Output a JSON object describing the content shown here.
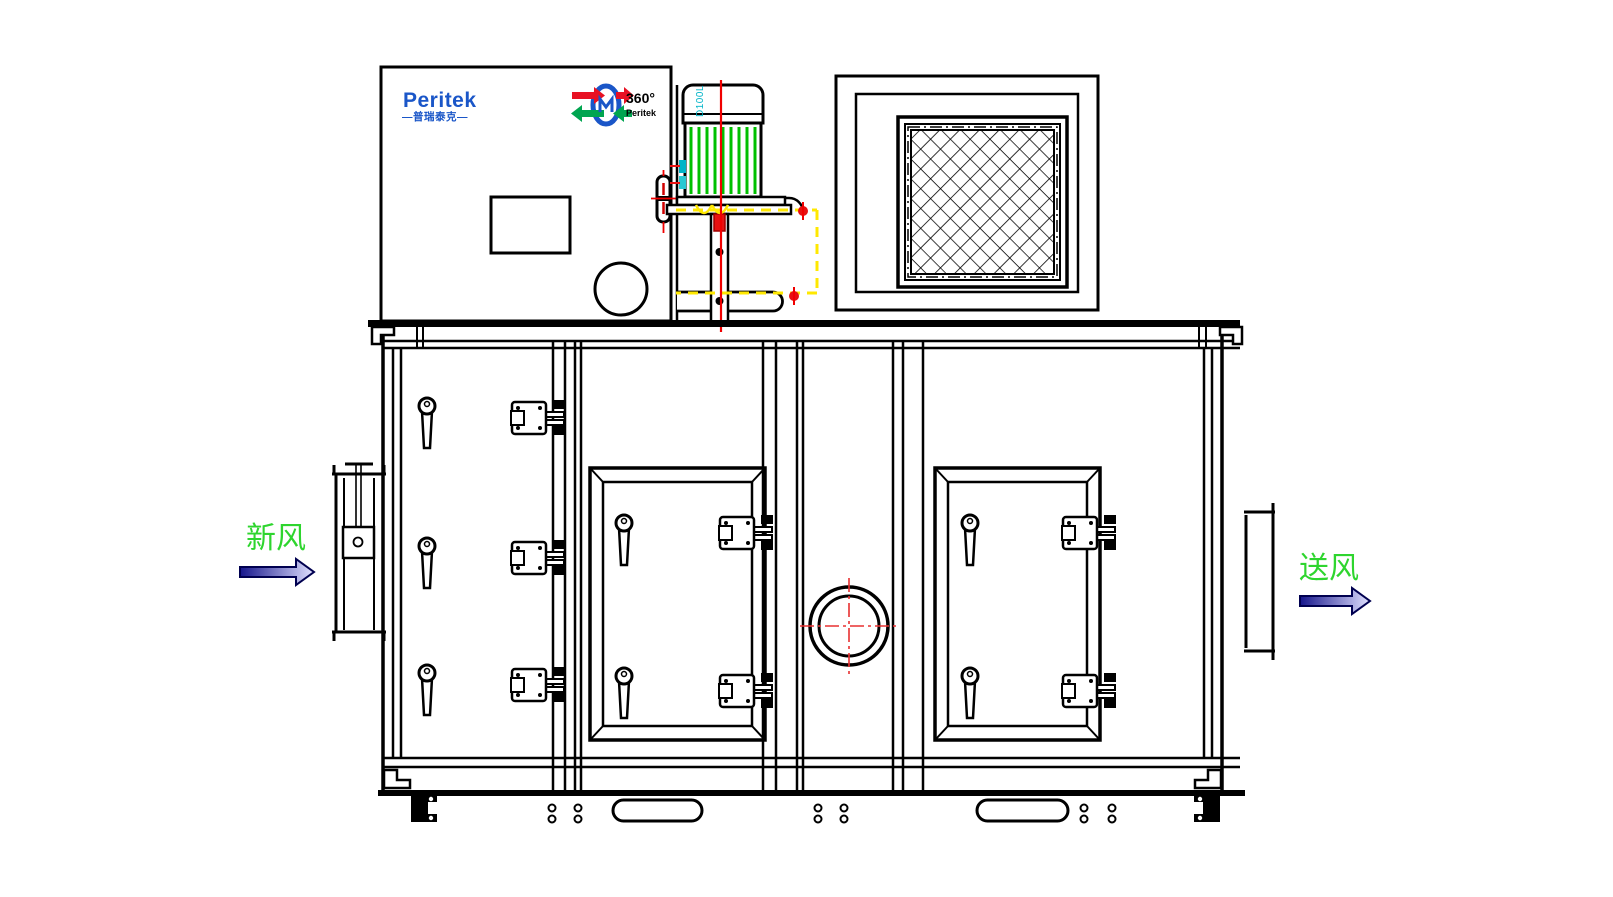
{
  "page": {
    "background": "#ffffff",
    "description": "CAD front-view drawing of a Peritek desiccant dehumidifier air handling unit"
  },
  "branding": {
    "logo_text": "Peritek",
    "logo_subtext": "—普瑞泰克—",
    "rotor_logo": {
      "angle_text": "360°",
      "brand_text": "Peritek"
    }
  },
  "annotations": {
    "fresh_air_label": "新风",
    "supply_air_label": "送风",
    "motor_model": "D100L"
  },
  "colors": {
    "line_black": "#000000",
    "logo_blue": "#1a56c8",
    "label_green": "#2ed52e",
    "arrow_dark_blue": "#16168c",
    "arrow_light_blue": "#e0e0ff",
    "arrow_outline": "#000050",
    "motor_fin_green": "#00c000",
    "centerline_red": "#f00000",
    "detail_red": "#e81111",
    "mount_guide_yellow": "#ffe800",
    "model_text_cyan": "#00b4c8",
    "rotor_arrow_red": "#e81123",
    "rotor_arrow_green": "#00a550"
  },
  "components": [
    "brand-panel",
    "electrical-box",
    "inspection-circle",
    "drive-motor",
    "motor-mount",
    "return-air-filter",
    "cabinet-body",
    "left-fixed-panel",
    "access-door-middle",
    "access-door-right",
    "sight-glass",
    "fresh-air-inlet-duct",
    "supply-air-outlet-duct",
    "base-frame",
    "forklift-slots",
    "anchor-feet"
  ]
}
